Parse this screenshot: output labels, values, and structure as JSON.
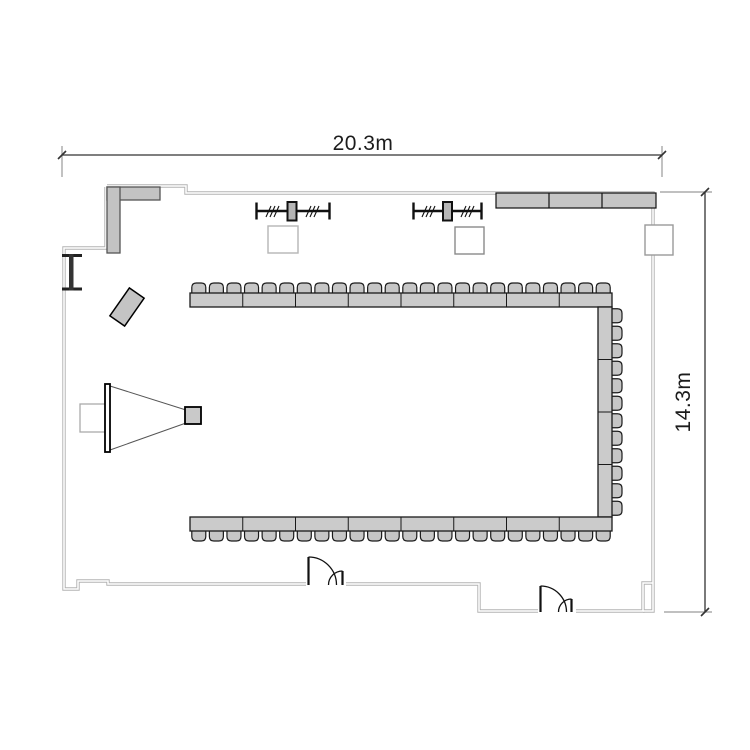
{
  "drawing": {
    "type": "floor-plan",
    "room": "meeting-room",
    "background": "#ffffff"
  },
  "dimensions": {
    "width_label": "20.3m",
    "height_label": "14.3m"
  },
  "colors": {
    "wall_line": "#b3b3b3",
    "dim_line": "#333333",
    "ext_line": "#9a9a9a",
    "door_line": "#111111",
    "furniture_gray": "#c6c6c6",
    "counter_gray": "#c3c3c3",
    "outline_black": "#1a1a1a"
  },
  "furniture": {
    "table_fill": "#cbcbcb",
    "table_stroke": "#1a1a1a",
    "chair_fill": "#c6c6c6",
    "chair_stroke": "#1a1a1a",
    "total_seats": 60,
    "runs": [
      {
        "name": "table-run-top",
        "orientation": "h",
        "x": 190,
        "y": 293,
        "length": 422,
        "depth": 14,
        "segments": 8,
        "chair_count": 24,
        "chair_side": "up"
      },
      {
        "name": "table-run-right",
        "orientation": "v",
        "x": 598,
        "y": 307,
        "length": 210,
        "depth": 14,
        "segments": 4,
        "chair_count": 12,
        "chair_side": "right"
      },
      {
        "name": "table-run-bottom",
        "orientation": "h",
        "x": 190,
        "y": 517,
        "length": 422,
        "depth": 14,
        "segments": 8,
        "chair_count": 24,
        "chair_side": "down"
      }
    ]
  },
  "equipment": {
    "screen": "projection-screen",
    "projector": "projector",
    "cone": "projection-cone",
    "lectern": "lectern",
    "counter": "corner-counter",
    "cabinets": "wall-cabinet-row",
    "cabinet_sections": 3,
    "partition_tracks": 2,
    "columns": 3,
    "doors": 2
  }
}
